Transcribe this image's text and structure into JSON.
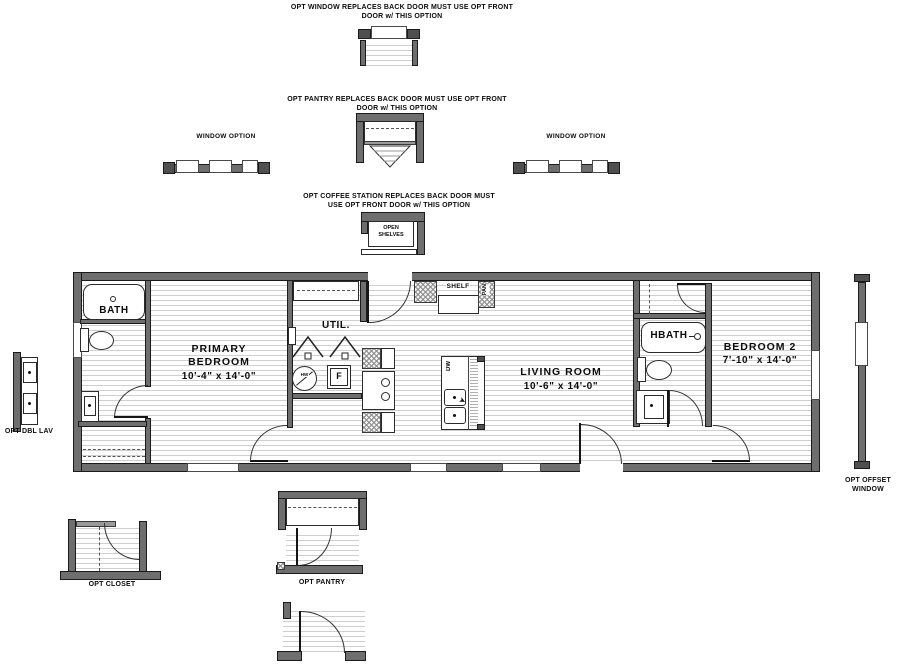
{
  "top": {
    "opt_window_caption1": "OPT WINDOW REPLACES BACK DOOR MUST USE OPT FRONT",
    "opt_window_caption2": "DOOR w/ THIS OPTION",
    "opt_pantry_caption1": "OPT PANTRY REPLACES BACK DOOR MUST USE OPT FRONT",
    "opt_pantry_caption2": "DOOR w/ THIS OPTION",
    "window_option_left": "WINDOW OPTION",
    "window_option_right": "WINDOW OPTION",
    "opt_coffee_caption1": "OPT COFFEE STATION REPLACES BACK DOOR MUST",
    "opt_coffee_caption2": "USE OPT FRONT DOOR w/ THIS OPTION",
    "open_shelves1": "OPEN",
    "open_shelves2": "SHELVES"
  },
  "plan": {
    "bath": "BATH",
    "primary1": "PRIMARY",
    "primary2": "BEDROOM",
    "primary_dims": "10'-4\" x  14'-0\"",
    "util": "UTIL.",
    "shelf": "SHELF",
    "pan": "PAN",
    "dw": "DW",
    "hw": "HW",
    "furnace": "F",
    "living": "LIVING ROOM",
    "living_dims": "10'-6\" x  14'-0\"",
    "hbath": "HBATH",
    "bedroom2": "BEDROOM 2",
    "bedroom2_dims": "7'-10\" x  14'-0\""
  },
  "side": {
    "opt_dbl_lav": "OPT DBL LAV",
    "opt_offset1": "OPT OFFSET",
    "opt_offset2": "WINDOW"
  },
  "bottom": {
    "opt_closet": "OPT CLOSET",
    "opt_pantry": "OPT PANTRY"
  }
}
